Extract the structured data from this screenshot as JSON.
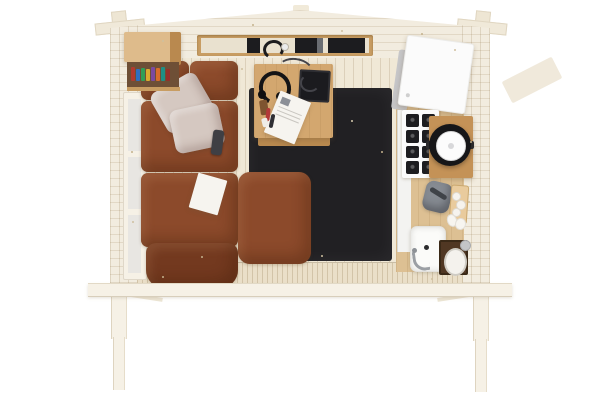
{
  "scene": {
    "type": "3d aerial cutaway render",
    "subject": "log cabin interior viewed from above with roof removed",
    "background": "#ffffff"
  },
  "palette": {
    "background": "#ffffff",
    "wall_wood": "#f2ecdf",
    "floor_wood": "#f0e8d6",
    "front_band": "#eadfc8",
    "trim_white": "#f6f1e6",
    "window_glass": "#e8e6e2",
    "oak_furniture": "#d3a76f",
    "oak_dark": "#b9894f",
    "shelf_frame": "#c89d63",
    "bookshelf_wood": "#debb8b",
    "bookshelf_recess": "#6e4f36",
    "nook_wood": "#ddc093",
    "counter_wood": "#c49257",
    "dark_wood": "#503723",
    "sofa_brown": "#8c4a2b",
    "sofa_brown_dark": "#73391f",
    "pillow_grey": "#d5c8c1",
    "rug_black": "#212023",
    "appliance_white": "#fbfbfb",
    "appliance_side_grey": "#c6c6c8",
    "burner_black": "#1d1d20",
    "pot_black": "#161618",
    "lid_white": "#fcfcfc",
    "kettle_grey": "#868b92",
    "ceramic_white": "#fbfbf9",
    "chrome_grey": "#9b9fa4",
    "laptop_black": "#1b1b1f",
    "media_slot_black": "#1c1c1f",
    "paper_white": "#f6f4ef"
  },
  "objects": {
    "cabin": {
      "label": "Whitewashed log cabin shell, top-down cutaway, gable peak at top"
    },
    "porch": {
      "label": "Front beam with two support posts and braces",
      "post_count": 2
    },
    "glazed_door": {
      "label": "Glazed door with white frame on left wall",
      "pane_count": 3
    },
    "wall_shelf": {
      "label": "Recessed wall shelf with dark media slots, headphones and a cup"
    },
    "bookshelf": {
      "label": "Corner wall cabinet with a row of books underneath",
      "book_colors": [
        "#b23a2e",
        "#2e6fc1",
        "#2f9e57",
        "#d9ab2f",
        "#7a4aa0",
        "#d96c2a",
        "#1f8f85",
        "#97302a"
      ]
    },
    "sofa": {
      "label": "Rust-brown corner sofa with two grey pillows",
      "pillow_count": 2,
      "items": [
        "remote control",
        "open booklet"
      ]
    },
    "ottoman": {
      "label": "Rust-brown ottoman on the rug"
    },
    "rug": {
      "label": "Large dark charcoal area rug"
    },
    "desk": {
      "label": "Square oak table",
      "items": [
        "laptop",
        "headphones with cable",
        "magazine",
        "stationery"
      ]
    },
    "kitchen": {
      "fridge": {
        "label": "White mini fridge in top-right corner"
      },
      "stove": {
        "label": "White gas hob with black grates",
        "burner_grid": {
          "rows": 4,
          "cols": 2
        }
      },
      "pot": {
        "label": "Black pot with white lid on wooden counter"
      },
      "counter": {
        "label": "Oak counter board"
      },
      "kettle": {
        "label": "Grey kettle"
      },
      "cutting_board": {
        "label": "Cutting board with garlic and eggs",
        "garlic_count": 3,
        "egg_count": 2
      },
      "sink": {
        "label": "White square basin with chrome faucet"
      },
      "washstand": {
        "label": "Dark wood washstand with white oval basin"
      }
    }
  }
}
